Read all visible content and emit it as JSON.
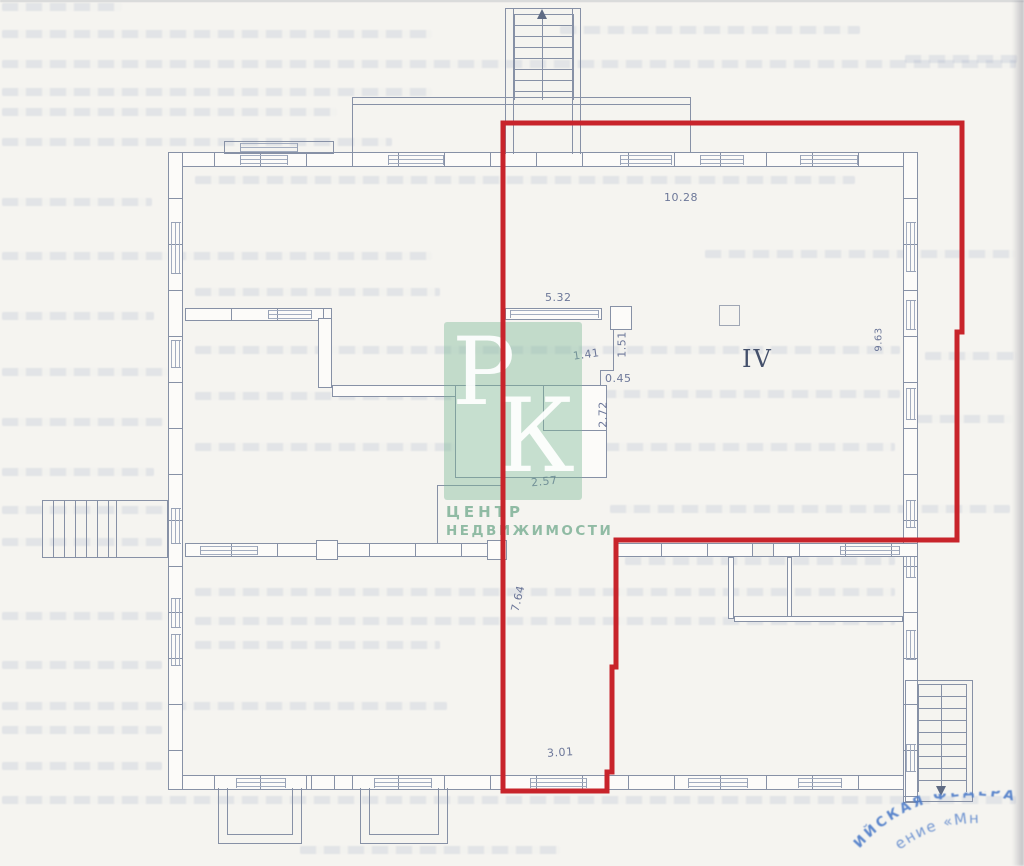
{
  "plan": {
    "room_label": "IV",
    "dims": {
      "top_width": "10.28",
      "partition_width": "5.32",
      "niche_height": "1.51",
      "jog_width": "1.41",
      "jog_depth": "0.45",
      "unit_height": "2.72",
      "unit_width": "2.57",
      "right_depth": "9.63",
      "left_depth": "7.64",
      "bottom_width": "3.01"
    },
    "highlight_color": "#c8242b",
    "line_color": "#8791a6"
  },
  "watermark": {
    "monogram_top": "Р",
    "monogram_bottom": "К",
    "line1": "ЦЕНТР",
    "line2": "НЕДВИЖИМОСТИ",
    "color": "#7cb796"
  },
  "stamp": {
    "arc_text": "ИЙСКАЯ ФЕДЕРАЦ",
    "inner_text": "ение «Мн",
    "color": "#4f7dc9"
  }
}
